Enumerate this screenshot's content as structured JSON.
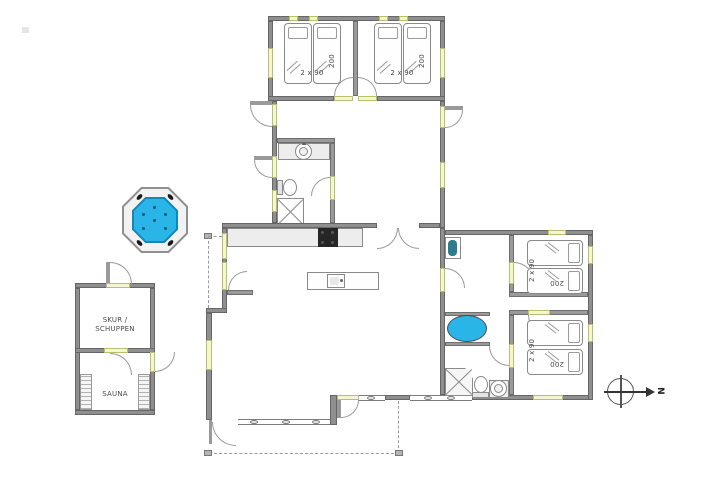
{
  "rooms": {
    "bedroom_top_left": {
      "bed_size": "2 x 90",
      "bed_length": "200"
    },
    "bedroom_top_right": {
      "bed_size": "2 x 90",
      "bed_length": "200"
    },
    "bedroom_right_upper": {
      "bed_size": "2 x 90",
      "bed_length": "200"
    },
    "bedroom_right_lower": {
      "bed_size": "2 x 90",
      "bed_length": "200"
    },
    "shed": {
      "name_line1": "SKUR /",
      "name_line2": "SCHUPPEN"
    },
    "sauna": {
      "name": "SAUNA"
    }
  },
  "compass": {
    "north": "N"
  },
  "colors": {
    "wall": "#8f8f8f",
    "window_fill": "#f3f6cf",
    "water_blue": "#2ab5e9",
    "stove": "#262626"
  }
}
